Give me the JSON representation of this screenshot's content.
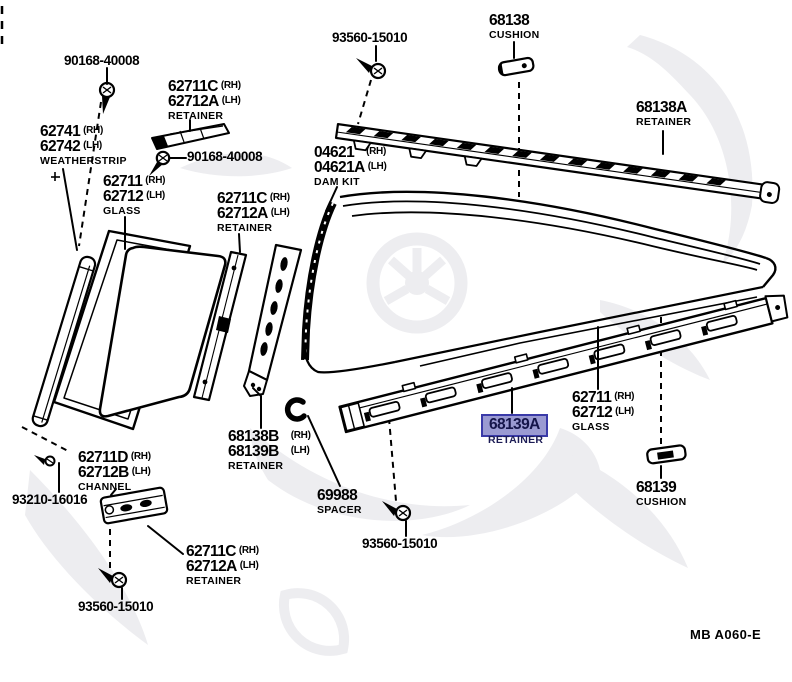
{
  "page": {
    "background": "#ffffff",
    "footer_code": "MB A060-E"
  },
  "highlight": {
    "fill": "#9a9ad2",
    "border": "#3a3aa8",
    "text": "#15154a",
    "selected_part": "68139A"
  },
  "labels": [
    {
      "name": "bolt-90168-40008-top",
      "x": 64,
      "y": 54,
      "lines": [
        {
          "t": "90168-40008",
          "size": "sm"
        }
      ]
    },
    {
      "name": "retainer-62711c-top",
      "x": 168,
      "y": 79,
      "lines": [
        {
          "t": "62711C",
          "s": "(RH)"
        },
        {
          "t": "62712A",
          "s": "(LH)"
        }
      ],
      "desc": "RETAINER"
    },
    {
      "name": "bolt-90168-40008-mid",
      "x": 187,
      "y": 150,
      "lines": [
        {
          "t": "90168-40008",
          "size": "sm"
        }
      ]
    },
    {
      "name": "weatherstrip-62741",
      "x": 40,
      "y": 124,
      "lines": [
        {
          "t": "62741",
          "s": "(RH)"
        },
        {
          "t": "62742",
          "s": "(LH)"
        }
      ],
      "desc": "WEATHERSTRIP"
    },
    {
      "name": "glass-62711-left",
      "x": 103,
      "y": 174,
      "lines": [
        {
          "t": "62711",
          "s": "(RH)"
        },
        {
          "t": "62712",
          "s": "(LH)"
        }
      ],
      "desc": "GLASS"
    },
    {
      "name": "screw-93560-15010-top",
      "x": 332,
      "y": 31,
      "lines": [
        {
          "t": "93560-15010",
          "size": "sm"
        }
      ]
    },
    {
      "name": "cushion-68138",
      "x": 489,
      "y": 13,
      "lines": [
        {
          "t": "68138"
        }
      ],
      "desc": "CUSHION"
    },
    {
      "name": "retainer-68138a",
      "x": 636,
      "y": 100,
      "lines": [
        {
          "t": "68138A"
        }
      ],
      "desc": "RETAINER"
    },
    {
      "name": "damkit-04621",
      "x": 314,
      "y": 145,
      "lines": [
        {
          "t": "04621",
          "s": "(RH)",
          "gap": true
        },
        {
          "t": "04621A",
          "s": "(LH)"
        }
      ],
      "desc": "DAM KIT"
    },
    {
      "name": "retainer-62711c-mid",
      "x": 217,
      "y": 191,
      "lines": [
        {
          "t": "62711C",
          "s": "(RH)"
        },
        {
          "t": "62712A",
          "s": "(LH)"
        }
      ],
      "desc": "RETAINER"
    },
    {
      "name": "glass-62711-right",
      "x": 572,
      "y": 390,
      "lines": [
        {
          "t": "62711",
          "s": "(RH)"
        },
        {
          "t": "62712",
          "s": "(LH)"
        }
      ],
      "desc": "GLASS"
    },
    {
      "name": "retainer-68139a-selected",
      "x": 489,
      "y": 417,
      "hl": true,
      "lines": [
        {
          "t": "68139A",
          "hl": true
        }
      ],
      "desc": "RETAINER",
      "desc_hl": true
    },
    {
      "name": "cushion-68139",
      "x": 636,
      "y": 480,
      "lines": [
        {
          "t": "68139"
        }
      ],
      "desc": "CUSHION"
    },
    {
      "name": "retainer-68138b",
      "x": 228,
      "y": 429,
      "lines": [
        {
          "t": "68138B",
          "s": "(RH)",
          "gap": true
        },
        {
          "t": "68139B",
          "s": "(LH)",
          "gap": true
        }
      ],
      "desc": "RETAINER"
    },
    {
      "name": "spacer-69988",
      "x": 317,
      "y": 488,
      "lines": [
        {
          "t": "69988"
        }
      ],
      "desc": "SPACER"
    },
    {
      "name": "screw-93560-15010-mid",
      "x": 362,
      "y": 537,
      "lines": [
        {
          "t": "93560-15010",
          "size": "sm"
        }
      ]
    },
    {
      "name": "channel-62711d",
      "x": 78,
      "y": 450,
      "lines": [
        {
          "t": "62711D",
          "s": "(RH)"
        },
        {
          "t": "62712B",
          "s": "(LH)"
        }
      ],
      "desc": "CHANNEL"
    },
    {
      "name": "bolt-93210-16016",
      "x": 12,
      "y": 493,
      "lines": [
        {
          "t": "93210-16016",
          "size": "sm"
        }
      ]
    },
    {
      "name": "retainer-62711c-bottom",
      "x": 186,
      "y": 544,
      "lines": [
        {
          "t": "62711C",
          "s": "(RH)"
        },
        {
          "t": "62712A",
          "s": "(LH)"
        }
      ],
      "desc": "RETAINER"
    },
    {
      "name": "screw-93560-15010-bottom",
      "x": 78,
      "y": 600,
      "lines": [
        {
          "t": "93560-15010",
          "size": "sm"
        }
      ]
    }
  ]
}
